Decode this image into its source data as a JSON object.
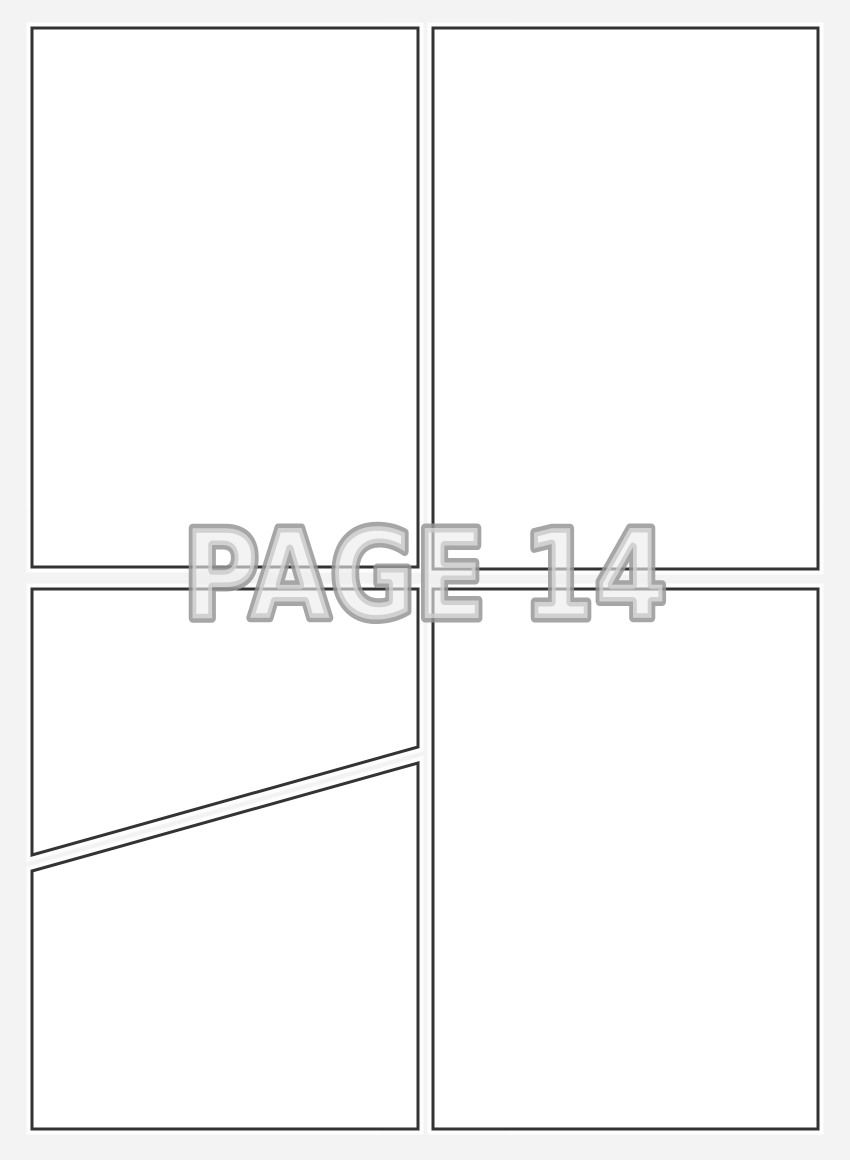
{
  "page_label": {
    "text": "PAGE 14"
  },
  "colors": {
    "background": "#f3f3f3",
    "panel_fill": "#ffffff",
    "panel_border": "#333333",
    "panel_halo": "#ffffff",
    "label_stroke": "#979797",
    "label_fill": "#ececec"
  },
  "panels": [
    {
      "id": "panel-top-left",
      "shape": "rectangle"
    },
    {
      "id": "panel-top-right",
      "shape": "rectangle"
    },
    {
      "id": "panel-bottom-left-upper",
      "shape": "diagonal-cut"
    },
    {
      "id": "panel-bottom-left-lower",
      "shape": "diagonal-cut"
    },
    {
      "id": "panel-bottom-right",
      "shape": "rectangle"
    }
  ]
}
